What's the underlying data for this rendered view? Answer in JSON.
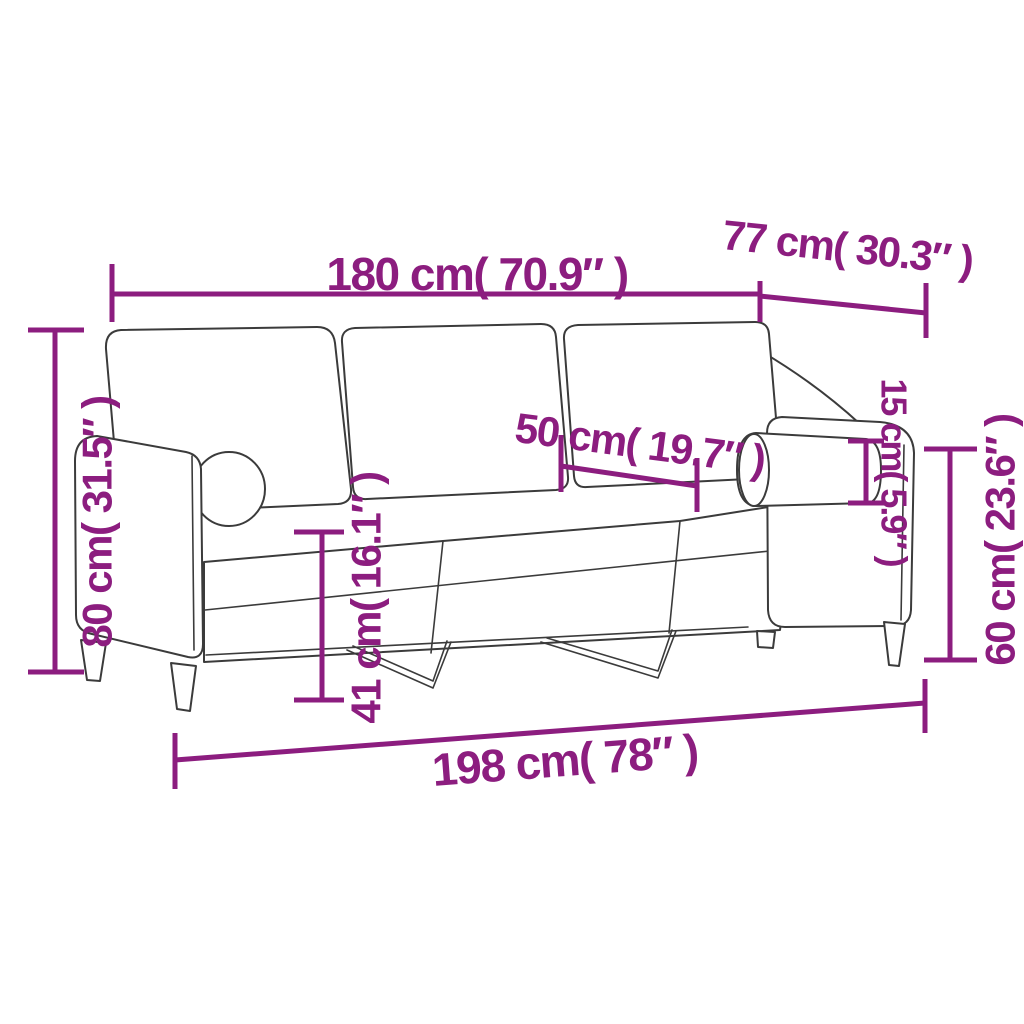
{
  "page": {
    "background": "#ffffff"
  },
  "colors": {
    "dimension": "#8C1D7F",
    "sofa_outline": "#3B3B3B"
  },
  "diagram": {
    "subject": "3-seater sofa with back cushions and bolster pillows, line drawing with measurements"
  },
  "dimensions": [
    {
      "id": "overall-width-top",
      "label": "180 cm( 70.9″ )"
    },
    {
      "id": "depth",
      "label": "77 cm( 30.3″ )"
    },
    {
      "id": "back-height",
      "label": "80 cm( 31.5″ )"
    },
    {
      "id": "seat-depth",
      "label": "50 cm( 19.7″ )"
    },
    {
      "id": "bolster-diameter",
      "label": "15 cm( 5.9″ )"
    },
    {
      "id": "armrest-height",
      "label": "60 cm( 23.6″ )"
    },
    {
      "id": "seat-height",
      "label": "41 cm( 16.1″ )"
    },
    {
      "id": "overall-width-bottom",
      "label": "198 cm( 78″ )"
    }
  ]
}
